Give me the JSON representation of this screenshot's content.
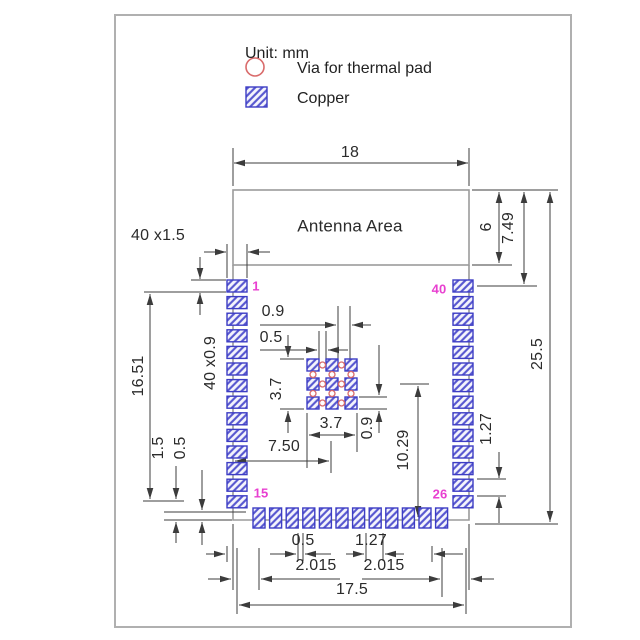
{
  "legend": {
    "unit": "Unit: mm",
    "via": "Via for thermal pad",
    "copper": "Copper"
  },
  "labels": {
    "top_width": "18",
    "antenna": "Antenna Area",
    "right_6": "6",
    "right_749": "7.49",
    "right_255": "25.5",
    "right_127": "1.27",
    "left_40x15": "40 x1.5",
    "left_1651": "16.51",
    "left_40x09": "40 x0.9",
    "left_15": "1.5",
    "left_05": "0.5",
    "mid_09": "0.9",
    "mid_05": "0.5",
    "pad_37_v": "3.7",
    "pad_37_h": "3.7",
    "pad_09_v": "0.9",
    "mid_750": "7.50",
    "mid_1029": "10.29",
    "bot_05": "0.5",
    "bot_127": "1.27",
    "bot_2015_l": "2.015",
    "bot_2015_r": "2.015",
    "bot_175": "17.5"
  },
  "pins": {
    "top_left": "1",
    "top_right": "40",
    "bottom_left": "15",
    "bottom_right": "26"
  },
  "pads": {
    "left_count": 14,
    "right_count": 14,
    "bottom_count": 12,
    "thermal_rows": 3,
    "thermal_cols": 3,
    "via_count": 12
  },
  "colors": {
    "copper_hatch": "#5555cf",
    "copper_border": "#3d3dc4",
    "via_red": "#d96b6b",
    "pin_magenta": "#e83fd0",
    "dim_line": "#3c3c3c",
    "outline_gray": "#9b9b9b"
  }
}
